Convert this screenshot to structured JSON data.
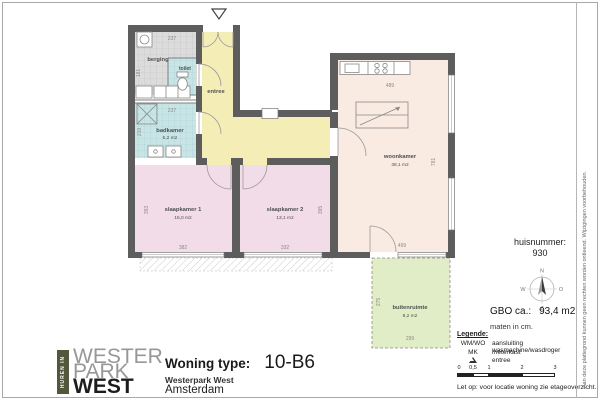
{
  "plan": {
    "rooms": {
      "berging": {
        "label": "berging"
      },
      "toilet": {
        "label": "toilet"
      },
      "badkamer": {
        "label": "badkamer",
        "area": "5,2 m2"
      },
      "entree": {
        "label": "entree"
      },
      "slaapkamer1": {
        "label": "slaapkamer 1",
        "area": "15,0 m2"
      },
      "slaapkamer2": {
        "label": "slaapkamer 2",
        "area": "13,1 m2"
      },
      "woonkamer": {
        "label": "woonkamer",
        "area": "38,1 m2"
      },
      "buitenruimte": {
        "label": "buitenruimte",
        "area": "8,2 m2"
      }
    },
    "dims": {
      "berging_w": "237",
      "berging_h": "181",
      "badkamer_w": "237",
      "badkamer_h": "219",
      "sk1_w": "382",
      "sk1_h": "393",
      "sk2_w": "332",
      "sk2_h": "395",
      "woon_w": "489",
      "woon_h": "781",
      "woon_door": "499",
      "buiten_w": "299",
      "buiten_h": "275"
    },
    "colors": {
      "wall": "#5d5d5d",
      "entree": "#f4eeb6",
      "bedroom": "#f2dce7",
      "living": "#f9eae2",
      "wet": "#c9e4e6",
      "storage": "#dcdcdc",
      "outdoor": "#e0edc6"
    }
  },
  "sidebar": {
    "huisnummer_label": "huisnummer:",
    "huisnummer_value": "930",
    "compass": {
      "n": "N",
      "e": "O",
      "s": "Z",
      "w": "W"
    },
    "gbo_label": "GBO ca.:",
    "gbo_value": "93,4 m2",
    "maten": "maten in cm.",
    "legend": {
      "title": "Legende:",
      "items": [
        {
          "key": "WM/WO",
          "value": "aansluiting wasmachine/wasdroger"
        },
        {
          "key": "MK",
          "value": "meterkast"
        },
        {
          "key": "",
          "value": "entree"
        }
      ]
    },
    "scale_labels": [
      "0",
      "0,5",
      "1",
      "2",
      "3"
    ],
    "note": "Let op:  voor locatie woning zie etageoverzicht."
  },
  "disclaimer": "Aan deze plattegrond kunnen geen rechten worden ontleend. Wijzigingen voorbehouden.",
  "footer": {
    "logo": {
      "tagline": "HUREN IN",
      "line1": "WESTER",
      "line2": "PARK",
      "line3": "WEST"
    },
    "woning_type_label": "Woning type:",
    "woning_type_value": "10-B6",
    "project": "Westerpark West",
    "city": "Amsterdam"
  }
}
